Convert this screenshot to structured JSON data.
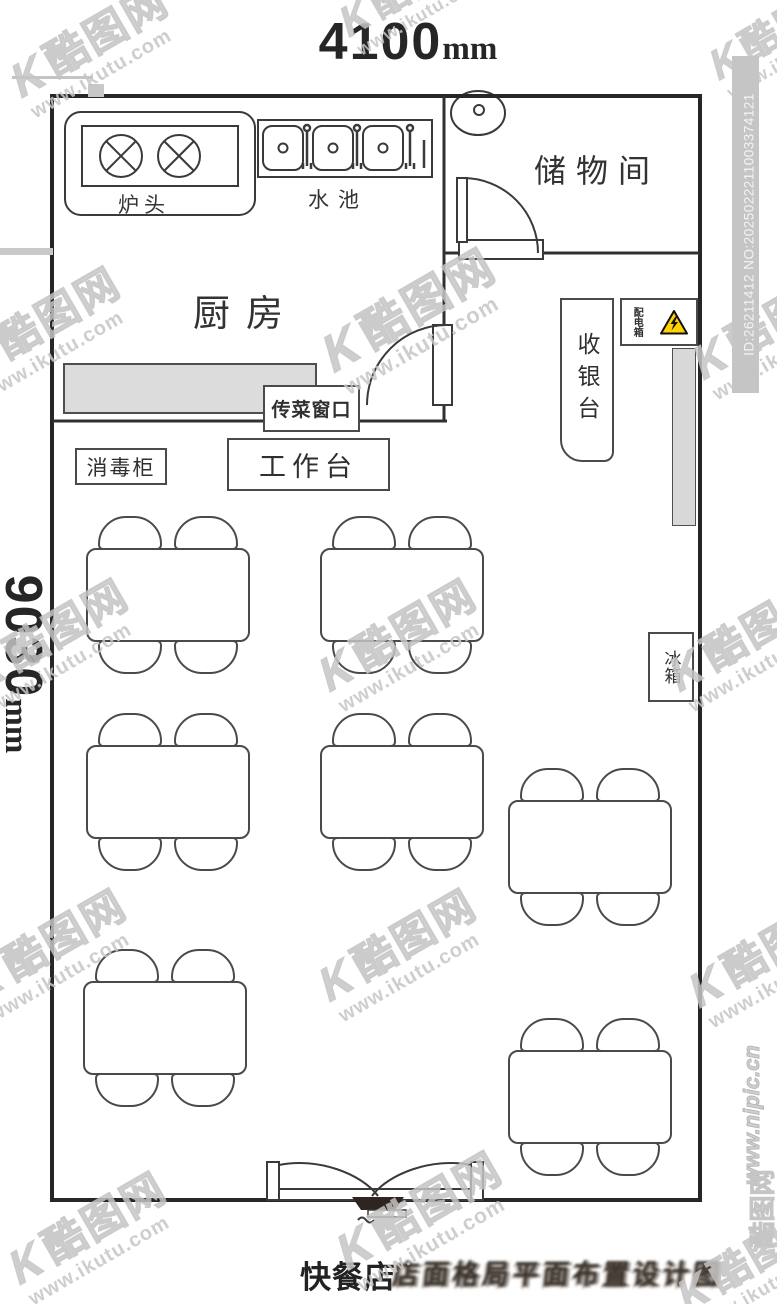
{
  "dimensions": {
    "top_value": "4100",
    "top_unit": "mm",
    "left_value": "9030",
    "left_unit": "mm"
  },
  "rooms": {
    "kitchen": "厨房",
    "storage": "储物间"
  },
  "equipment": {
    "stove": "炉头",
    "sink": "水池",
    "serving_window": "传菜窗口",
    "disinfection_cabinet": "消毒柜",
    "worktable": "工作台",
    "cashier": "收银台",
    "distribution_box": "配电箱",
    "fridge": "冰箱"
  },
  "caption": {
    "shop": "快餐店",
    "garbled": "店面格局平面布置设计图"
  },
  "watermark": {
    "brand_k": "K",
    "brand": "酷图网",
    "url": "www.ikutu.com",
    "id_bar": "ID:26211412 NO:2025022211003374121",
    "nipic": "www.nipic.cn",
    "nipic_logo": "酷图网"
  },
  "furniture": {
    "tables": 7,
    "chairs_per_table": 4
  },
  "colors": {
    "line": "#3a3a3a",
    "wall": "#262626",
    "gray_fill": "#dcdcdc",
    "warning_yellow": "#ffd200",
    "watermark_gray": "#c9c9c9"
  }
}
